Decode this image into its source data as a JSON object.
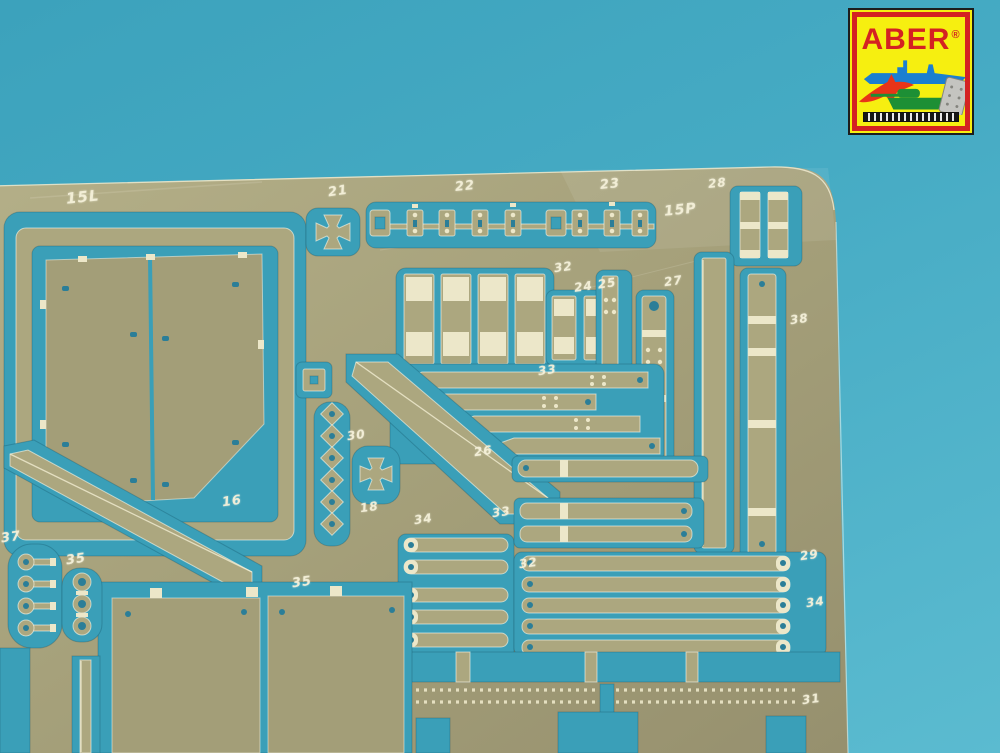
{
  "colors": {
    "teal-cut": "#3a9fb8",
    "hole": "#2b7e98",
    "brass-part": "#aca77f",
    "brass-panel": "#a39e78",
    "etch": "#ece7c9",
    "edge-light": "#f2edd2",
    "logo-yellow": "#f6ef10",
    "logo-red": "#d42222",
    "ship-blue": "#1b7fd0",
    "jet-red": "#e83418",
    "tank-green": "#1d8f35",
    "sheet-gray": "#c4c4c0"
  },
  "logo": {
    "brand": "ABER",
    "registered": "®"
  },
  "fret": {
    "etched_color": "#efe9cd",
    "part_labels": [
      {
        "text": "15L",
        "x": 66,
        "y": 188,
        "rot": -6,
        "size": 15
      },
      {
        "text": "21",
        "x": 328,
        "y": 184,
        "rot": -8,
        "size": 13
      },
      {
        "text": "22",
        "x": 455,
        "y": 179,
        "rot": -6,
        "size": 13
      },
      {
        "text": "23",
        "x": 600,
        "y": 177,
        "rot": -6,
        "size": 13
      },
      {
        "text": "28",
        "x": 708,
        "y": 176,
        "rot": -6,
        "size": 12
      },
      {
        "text": "15P",
        "x": 664,
        "y": 202,
        "rot": -6,
        "size": 14
      },
      {
        "text": "32",
        "x": 554,
        "y": 260,
        "rot": -8,
        "size": 12
      },
      {
        "text": "24 25",
        "x": 574,
        "y": 278,
        "rot": -8,
        "size": 12
      },
      {
        "text": "27",
        "x": 664,
        "y": 274,
        "rot": -8,
        "size": 12
      },
      {
        "text": "38",
        "x": 790,
        "y": 312,
        "rot": -8,
        "size": 12
      },
      {
        "text": "33",
        "x": 538,
        "y": 363,
        "rot": -8,
        "size": 12
      },
      {
        "text": "30",
        "x": 347,
        "y": 428,
        "rot": -8,
        "size": 12
      },
      {
        "text": "26",
        "x": 474,
        "y": 444,
        "rot": -8,
        "size": 12
      },
      {
        "text": "18",
        "x": 360,
        "y": 500,
        "rot": -8,
        "size": 12
      },
      {
        "text": "34",
        "x": 414,
        "y": 512,
        "rot": -8,
        "size": 12
      },
      {
        "text": "33",
        "x": 492,
        "y": 505,
        "rot": -8,
        "size": 12
      },
      {
        "text": "32",
        "x": 519,
        "y": 556,
        "rot": -8,
        "size": 12
      },
      {
        "text": "16",
        "x": 222,
        "y": 494,
        "rot": -8,
        "size": 13
      },
      {
        "text": "37",
        "x": 1,
        "y": 530,
        "rot": -8,
        "size": 13
      },
      {
        "text": "35",
        "x": 66,
        "y": 552,
        "rot": -8,
        "size": 13
      },
      {
        "text": "35",
        "x": 292,
        "y": 575,
        "rot": -8,
        "size": 13
      },
      {
        "text": "29",
        "x": 800,
        "y": 548,
        "rot": -8,
        "size": 12
      },
      {
        "text": "34",
        "x": 806,
        "y": 595,
        "rot": -8,
        "size": 12
      },
      {
        "text": "31",
        "x": 802,
        "y": 692,
        "rot": -8,
        "size": 12
      }
    ]
  }
}
